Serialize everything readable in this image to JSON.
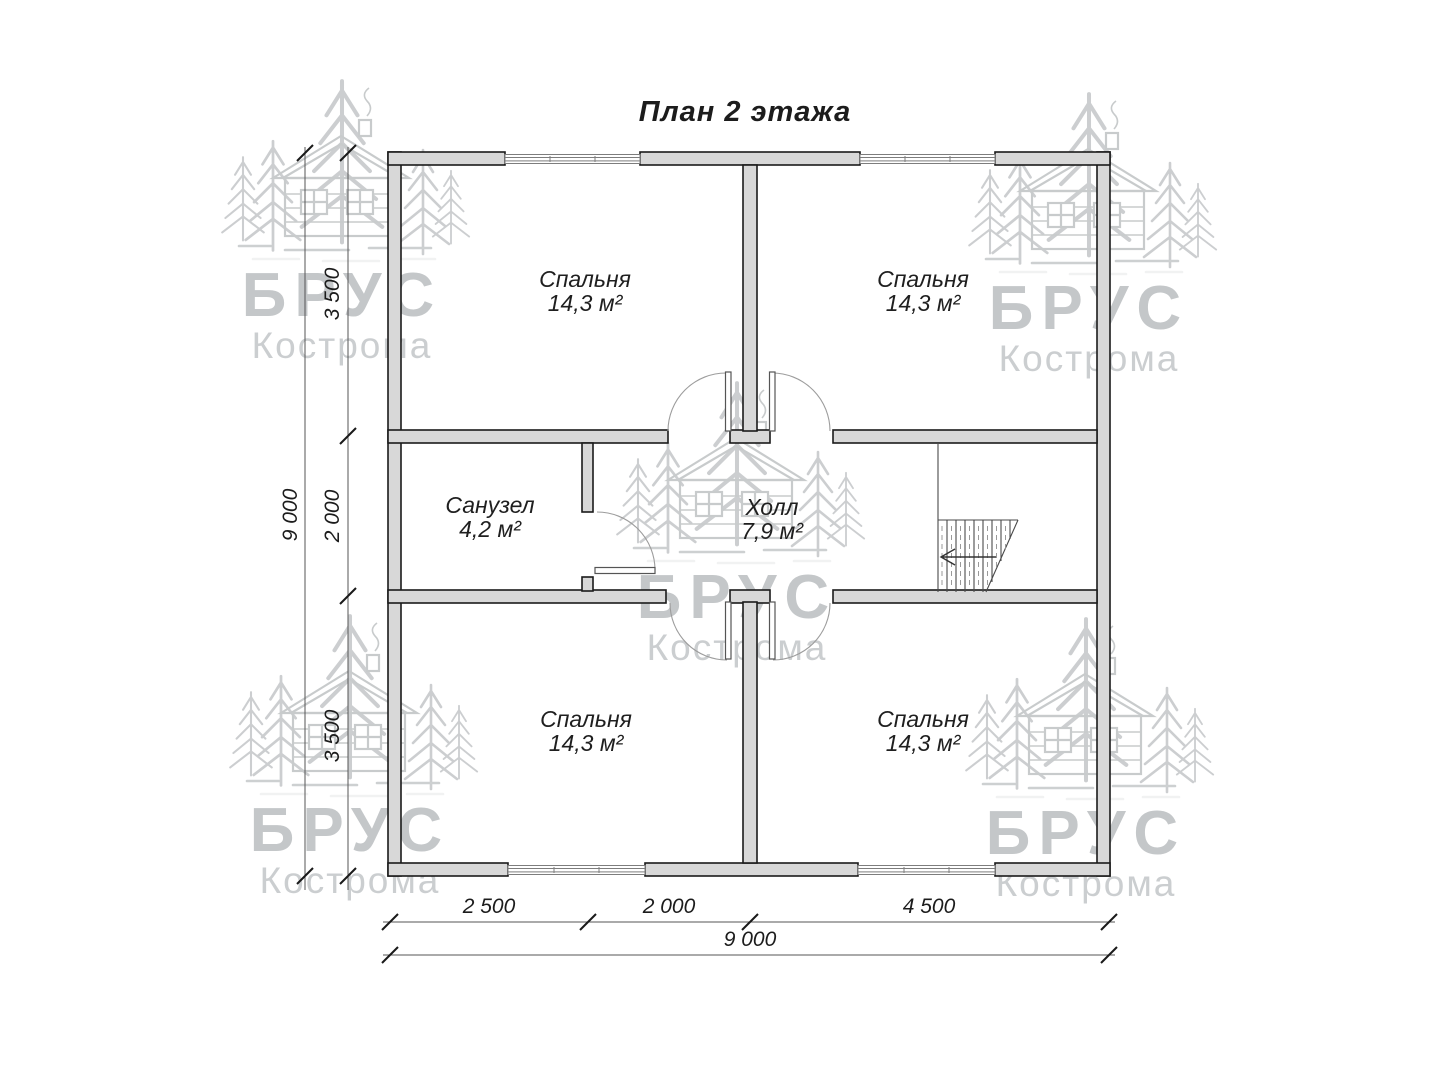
{
  "title": "План 2 этажа",
  "watermark": {
    "brand": "БРУС",
    "city": "Кострома"
  },
  "rooms": [
    {
      "key": "bedroom-top-left",
      "name": "Спальня",
      "area": "14,3 м²"
    },
    {
      "key": "bedroom-top-right",
      "name": "Спальня",
      "area": "14,3 м²"
    },
    {
      "key": "bathroom",
      "name": "Санузел",
      "area": "4,2 м²"
    },
    {
      "key": "hall",
      "name": "Холл",
      "area": "7,9 м²"
    },
    {
      "key": "bedroom-bottom-left",
      "name": "Спальня",
      "area": "14,3 м²"
    },
    {
      "key": "bedroom-bottom-right",
      "name": "Спальня",
      "area": "14,3 м²"
    }
  ],
  "dimensions": {
    "left": {
      "segments": [
        "3 500",
        "2 000",
        "3 500"
      ],
      "total": "9 000"
    },
    "bottom": {
      "segments": [
        "2 500",
        "2 000",
        "4 500"
      ],
      "total": "9 000"
    }
  }
}
